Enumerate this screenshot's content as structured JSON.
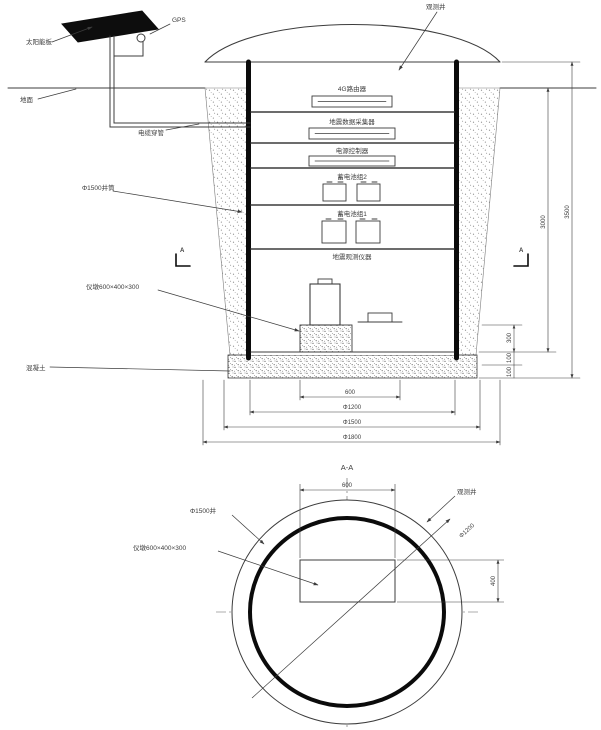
{
  "drawing_colors": {
    "line": "#3c3c3c",
    "heavy": "#0b0b0b",
    "panel_fill": "#0d0d0d",
    "speckle": "#8a8a8a"
  },
  "section": {
    "solar_panel_label": "太阳能板",
    "gps_label": "GPS",
    "dome_label": "观测井",
    "ground_label": "地面",
    "conduit_label": "电缆穿管",
    "wall_label": "Φ1500井筒",
    "concrete_label": "混凝土",
    "pier_label": "仪墩600×400×300",
    "section_mark": "A",
    "equipment": [
      "4G路由器",
      "地震数据采集器",
      "电源控制器",
      "蓄电池组2",
      "蓄电池组1",
      "地震观测仪器"
    ],
    "dims_bottom": [
      "600",
      "Φ1200",
      "Φ1500",
      "Φ1800"
    ],
    "dim_depth_inner": "3000",
    "dim_depth_outer": "3500",
    "dim_pier_height": "300",
    "dims_slab": [
      "100",
      "100"
    ]
  },
  "plan": {
    "title": "A-A",
    "dim_top": "600",
    "dim_right": "400",
    "dim_diagonal": "Φ1200",
    "wall_label": "Φ1500井",
    "pier_label": "仪墩600×400×300",
    "dome_label": "观测井"
  }
}
